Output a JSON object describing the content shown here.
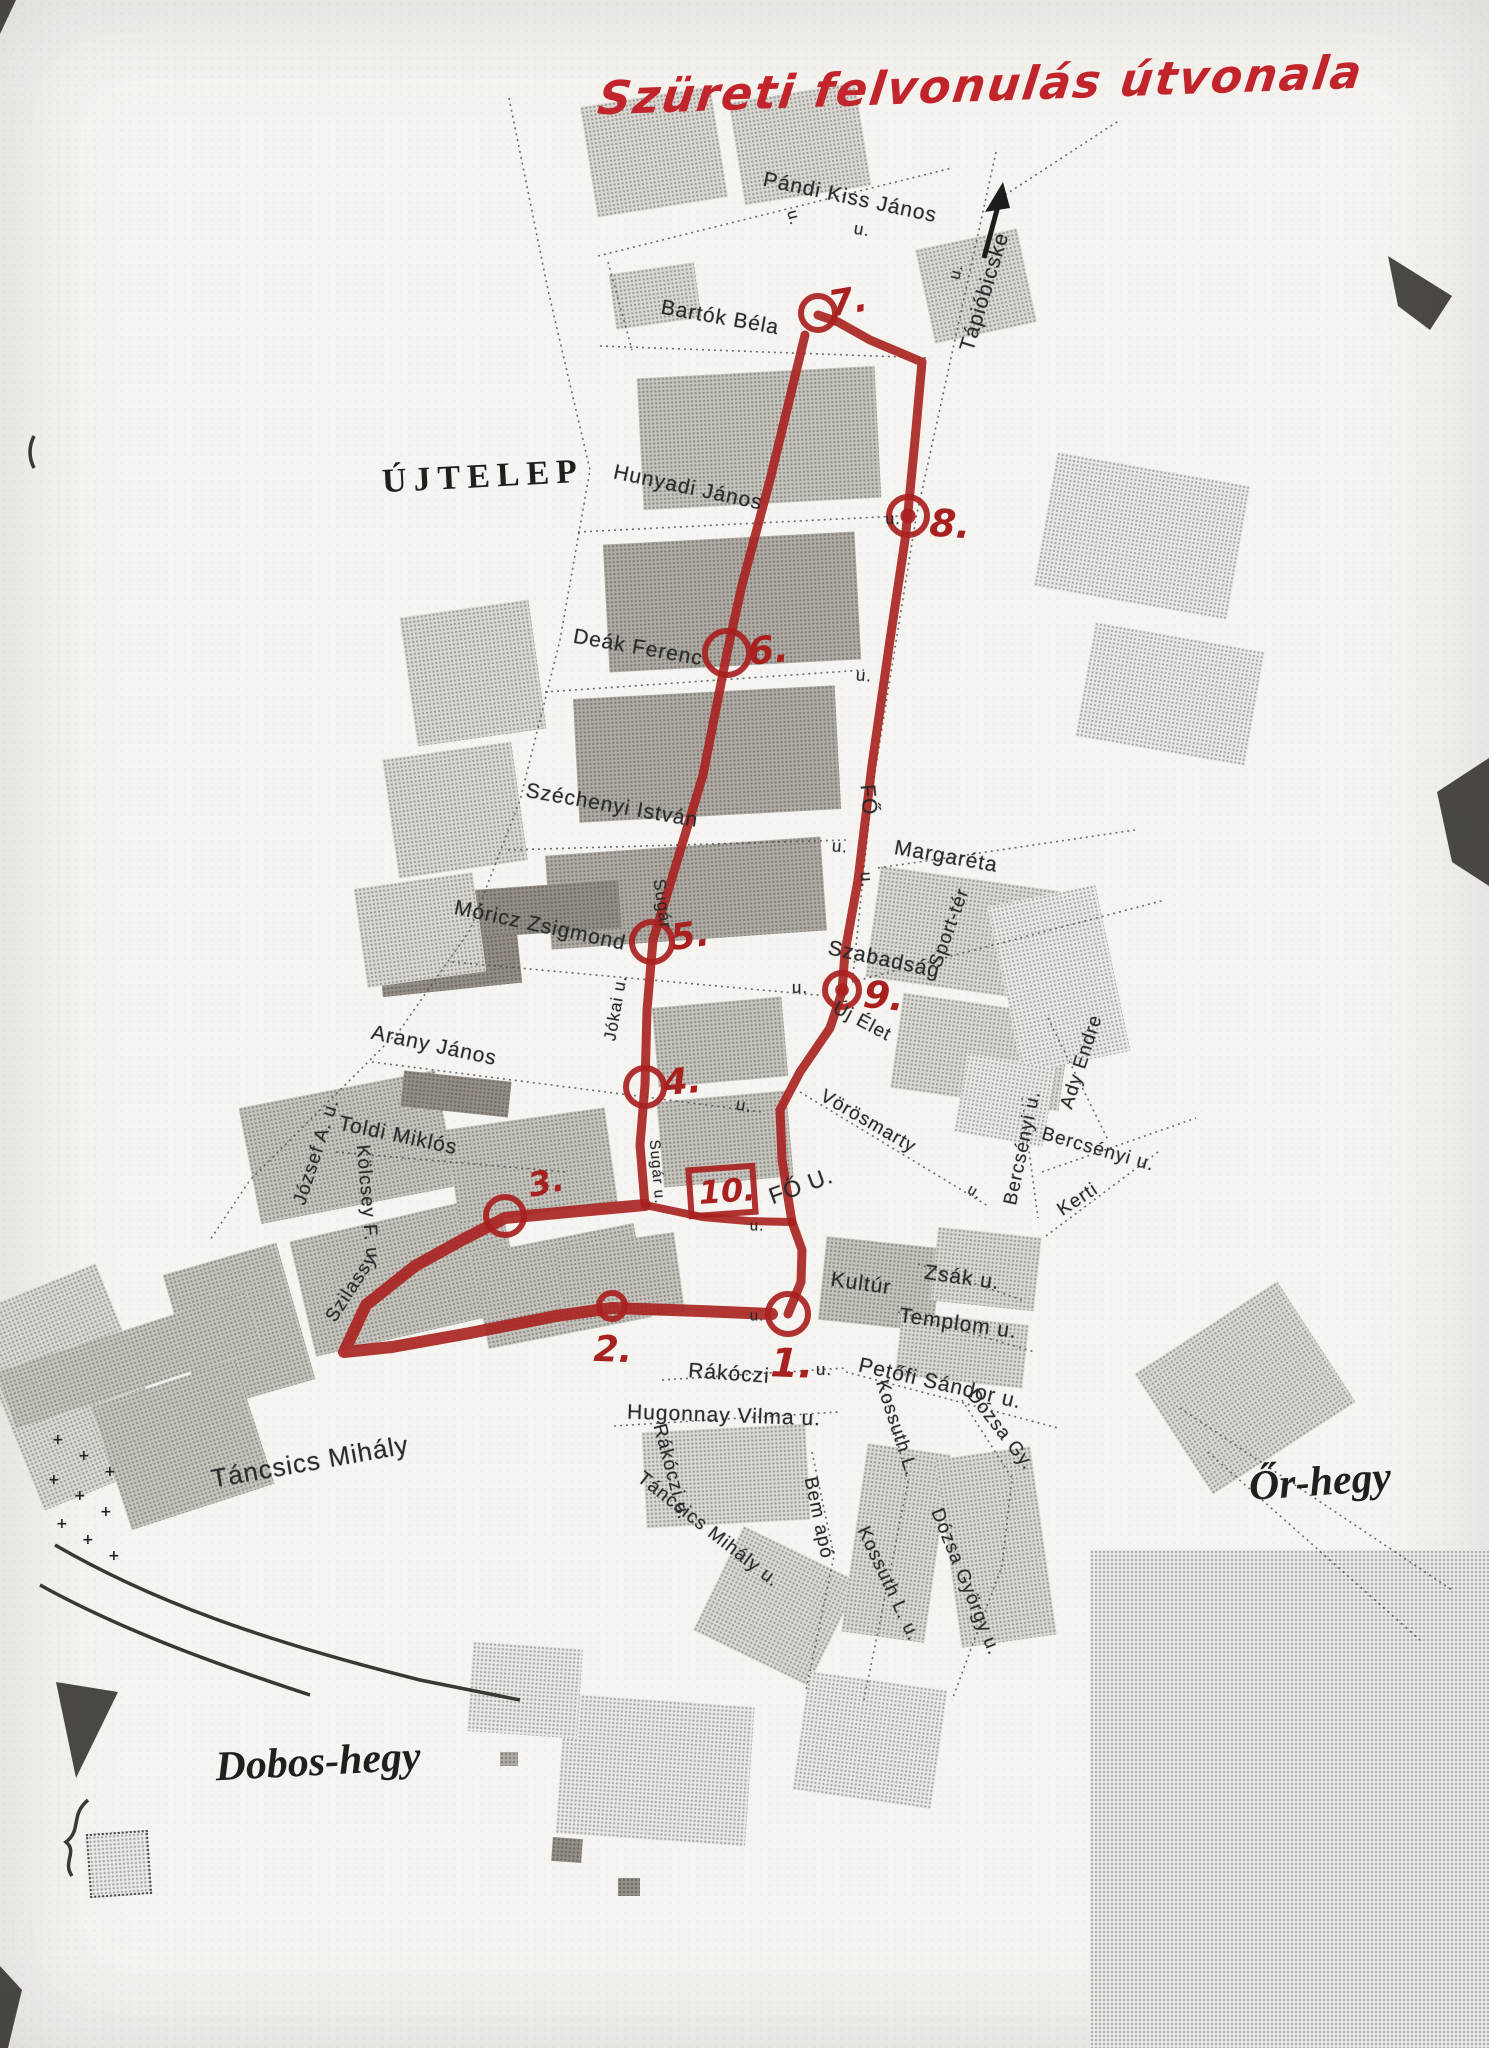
{
  "title": {
    "text": "Szüreti felvonulás útvonala",
    "color": "#c1242b"
  },
  "map": {
    "region_labels": [
      {
        "text": "ÚJTELEP",
        "x": 483,
        "y": 477,
        "rot": -3,
        "size": 34,
        "cls": "caps"
      },
      {
        "text": "Őr-hegy",
        "x": 1320,
        "y": 1482,
        "rot": -4,
        "size": 42,
        "cls": "italic"
      },
      {
        "text": "Dobos-hegy",
        "x": 318,
        "y": 1762,
        "rot": -3,
        "size": 42,
        "cls": "italic"
      }
    ],
    "street_labels": [
      {
        "text": "Pándi Kiss János",
        "x": 850,
        "y": 198,
        "rot": 12,
        "size": 21
      },
      {
        "text": "u.",
        "x": 862,
        "y": 230,
        "rot": 10,
        "size": 17
      },
      {
        "text": "u.",
        "x": 793,
        "y": 218,
        "rot": 75,
        "size": 16
      },
      {
        "text": "Tápióbicske",
        "x": 985,
        "y": 292,
        "rot": -73,
        "size": 21
      },
      {
        "text": "u.",
        "x": 957,
        "y": 272,
        "rot": -75,
        "size": 16
      },
      {
        "text": "Bartók Béla",
        "x": 720,
        "y": 318,
        "rot": 10,
        "size": 21
      },
      {
        "text": "Hunyadi János",
        "x": 688,
        "y": 488,
        "rot": 12,
        "size": 21
      },
      {
        "text": "u.",
        "x": 893,
        "y": 520,
        "rot": 0,
        "size": 16
      },
      {
        "text": "Deák Ferenc",
        "x": 638,
        "y": 648,
        "rot": 10,
        "size": 21
      },
      {
        "text": "u.",
        "x": 864,
        "y": 676,
        "rot": 5,
        "size": 17
      },
      {
        "text": "Széchenyi István",
        "x": 612,
        "y": 806,
        "rot": 10,
        "size": 21
      },
      {
        "text": "u.",
        "x": 840,
        "y": 847,
        "rot": 5,
        "size": 17
      },
      {
        "text": "FŐ",
        "x": 868,
        "y": 800,
        "rot": 85,
        "size": 21
      },
      {
        "text": "u.",
        "x": 866,
        "y": 880,
        "rot": 85,
        "size": 17
      },
      {
        "text": "Margaréta",
        "x": 946,
        "y": 857,
        "rot": 10,
        "size": 21
      },
      {
        "text": "Móricz Zsigmond",
        "x": 540,
        "y": 926,
        "rot": 12,
        "size": 21
      },
      {
        "text": "Sugár",
        "x": 662,
        "y": 904,
        "rot": 82,
        "size": 17
      },
      {
        "text": "Jókai u.",
        "x": 616,
        "y": 1008,
        "rot": -80,
        "size": 17
      },
      {
        "text": "Szabadság",
        "x": 884,
        "y": 960,
        "rot": 12,
        "size": 21
      },
      {
        "text": "u.",
        "x": 800,
        "y": 988,
        "rot": 0,
        "size": 17
      },
      {
        "text": "Új Élet",
        "x": 862,
        "y": 1022,
        "rot": 28,
        "size": 19
      },
      {
        "text": "Sport-tér",
        "x": 950,
        "y": 928,
        "rot": -70,
        "size": 19
      },
      {
        "text": "Arany János",
        "x": 434,
        "y": 1046,
        "rot": 12,
        "size": 21
      },
      {
        "text": "u.",
        "x": 744,
        "y": 1106,
        "rot": 10,
        "size": 17
      },
      {
        "text": "Toldi Miklós",
        "x": 398,
        "y": 1136,
        "rot": 12,
        "size": 21
      },
      {
        "text": "József A. u.",
        "x": 317,
        "y": 1152,
        "rot": -72,
        "size": 19
      },
      {
        "text": "Kölcsey F. u.",
        "x": 367,
        "y": 1205,
        "rot": 85,
        "size": 19
      },
      {
        "text": "Szilassy",
        "x": 352,
        "y": 1288,
        "rot": -57,
        "size": 19
      },
      {
        "text": "Vörösmarty",
        "x": 868,
        "y": 1122,
        "rot": 30,
        "size": 19
      },
      {
        "text": "u.",
        "x": 975,
        "y": 1192,
        "rot": 30,
        "size": 15
      },
      {
        "text": "Bercsényi u.",
        "x": 1023,
        "y": 1148,
        "rot": -78,
        "size": 19
      },
      {
        "text": "Bercsényi u.",
        "x": 1098,
        "y": 1150,
        "rot": 16,
        "size": 19
      },
      {
        "text": "Kerti",
        "x": 1078,
        "y": 1200,
        "rot": -33,
        "size": 19
      },
      {
        "text": "Ady Endre",
        "x": 1082,
        "y": 1062,
        "rot": -72,
        "size": 19
      },
      {
        "text": "FŐ U.",
        "x": 801,
        "y": 1186,
        "rot": -20,
        "size": 23
      },
      {
        "text": "u.",
        "x": 757,
        "y": 1226,
        "rot": 0,
        "size": 15
      },
      {
        "text": "Sugár u.",
        "x": 657,
        "y": 1172,
        "rot": 85,
        "size": 15
      },
      {
        "text": "Kultúr",
        "x": 861,
        "y": 1284,
        "rot": 8,
        "size": 21
      },
      {
        "text": "Zsák u.",
        "x": 962,
        "y": 1278,
        "rot": 8,
        "size": 21
      },
      {
        "text": "Templom u.",
        "x": 958,
        "y": 1324,
        "rot": 8,
        "size": 21
      },
      {
        "text": "u.",
        "x": 757,
        "y": 1316,
        "rot": 0,
        "size": 15
      },
      {
        "text": "Rákóczi",
        "x": 729,
        "y": 1374,
        "rot": 4,
        "size": 21
      },
      {
        "text": "u.",
        "x": 824,
        "y": 1370,
        "rot": 0,
        "size": 17
      },
      {
        "text": "Petőfi Sándor u.",
        "x": 940,
        "y": 1384,
        "rot": 13,
        "size": 21
      },
      {
        "text": "Hugonnay Vilma u.",
        "x": 724,
        "y": 1416,
        "rot": 2,
        "size": 21
      },
      {
        "text": "Rákóczi u.",
        "x": 671,
        "y": 1472,
        "rot": 75,
        "size": 19
      },
      {
        "text": "Táncsics Mihály",
        "x": 310,
        "y": 1462,
        "rot": -10,
        "size": 26
      },
      {
        "text": "Táncsics Mihály u.",
        "x": 708,
        "y": 1530,
        "rot": 38,
        "size": 19
      },
      {
        "text": "Bem apó",
        "x": 818,
        "y": 1518,
        "rot": 78,
        "size": 19
      },
      {
        "text": "Kossuth L.",
        "x": 896,
        "y": 1428,
        "rot": 72,
        "size": 19
      },
      {
        "text": "Kossuth L. u.",
        "x": 888,
        "y": 1584,
        "rot": 65,
        "size": 19
      },
      {
        "text": "Dózsa Gy.",
        "x": 1000,
        "y": 1430,
        "rot": 52,
        "size": 19
      },
      {
        "text": "Dózsa György u.",
        "x": 965,
        "y": 1582,
        "rot": 68,
        "size": 19
      }
    ],
    "route": {
      "color": "#a8211f",
      "segments": [
        {
          "pts": "805,335 770,480 742,585 727,653 703,775 672,878 653,940 647,1010 645,1085 640,1145 645,1205",
          "w": 9
        },
        {
          "pts": "645,1205 568,1212 505,1218 462,1240 415,1266 366,1305 344,1352 392,1347 470,1333 556,1316 612,1308 700,1311 772,1314",
          "w": 12
        },
        {
          "pts": "788,1314 801,1282 802,1250 792,1222",
          "w": 9
        },
        {
          "pts": "645,1205 702,1217 748,1221 792,1222",
          "w": 8
        },
        {
          "pts": "792,1222 782,1160 780,1110 800,1072 830,1028 842,992 845,952 858,880 872,765 890,640 905,540 908,512 915,440 922,362 870,340 838,322 818,315",
          "w": 9
        }
      ]
    },
    "markers": [
      {
        "id": "7",
        "shape": "circle",
        "cx": 818,
        "cy": 313,
        "r": 17,
        "label": "7.",
        "lx": 848,
        "ly": 302,
        "lsize": 36,
        "lrot": -10
      },
      {
        "id": "8",
        "shape": "double",
        "cx": 908,
        "cy": 516,
        "r": 19,
        "label": "8.",
        "lx": 950,
        "ly": 524,
        "lsize": 38,
        "lrot": 4
      },
      {
        "id": "6",
        "shape": "circle",
        "cx": 727,
        "cy": 653,
        "r": 22,
        "label": "6.",
        "lx": 768,
        "ly": 650,
        "lsize": 38,
        "lrot": -5
      },
      {
        "id": "5",
        "shape": "circle",
        "cx": 652,
        "cy": 942,
        "r": 20,
        "label": "5.",
        "lx": 690,
        "ly": 936,
        "lsize": 36,
        "lrot": -8
      },
      {
        "id": "9",
        "shape": "double",
        "cx": 842,
        "cy": 990,
        "r": 17,
        "label": "9.",
        "lx": 884,
        "ly": 996,
        "lsize": 38,
        "lrot": 6
      },
      {
        "id": "4",
        "shape": "circle",
        "cx": 645,
        "cy": 1087,
        "r": 19,
        "label": "4.",
        "lx": 682,
        "ly": 1082,
        "lsize": 36,
        "lrot": -5
      },
      {
        "id": "3",
        "shape": "circle",
        "cx": 505,
        "cy": 1216,
        "r": 19,
        "label": "3.",
        "lx": 546,
        "ly": 1182,
        "lsize": 33,
        "lrot": -12
      },
      {
        "id": "10",
        "shape": "square",
        "cx": 722,
        "cy": 1191,
        "w": 64,
        "h": 46,
        "rot": -4,
        "label": "10.",
        "lx": 727,
        "ly": 1191,
        "lsize": 32,
        "lrot": -4
      },
      {
        "id": "1",
        "shape": "circle",
        "cx": 788,
        "cy": 1314,
        "r": 20,
        "label": "1.",
        "lx": 792,
        "ly": 1364,
        "lsize": 40,
        "lrot": 2
      },
      {
        "id": "2",
        "shape": "circle",
        "cx": 612,
        "cy": 1306,
        "r": 13,
        "label": "2.",
        "lx": 613,
        "ly": 1350,
        "lsize": 36,
        "lrot": 2
      }
    ],
    "decor": {
      "blocks": [
        [
          588,
          96,
          132,
          112,
          -9,
          1
        ],
        [
          736,
          92,
          128,
          104,
          -9,
          1
        ],
        [
          612,
          268,
          86,
          56,
          -8,
          1
        ],
        [
          640,
          372,
          238,
          132,
          -3,
          2
        ],
        [
          606,
          538,
          252,
          128,
          -3,
          3
        ],
        [
          576,
          692,
          262,
          124,
          -3,
          3
        ],
        [
          548,
          846,
          276,
          94,
          -4,
          3
        ],
        [
          470,
          885,
          150,
          48,
          -4,
          4
        ],
        [
          380,
          940,
          140,
          50,
          -6,
          4
        ],
        [
          408,
          608,
          130,
          130,
          -8,
          1
        ],
        [
          390,
          750,
          130,
          120,
          -8,
          1
        ],
        [
          360,
          880,
          120,
          100,
          -8,
          1
        ],
        [
          924,
          238,
          104,
          96,
          -12,
          1
        ],
        [
          1044,
          468,
          196,
          136,
          10,
          0
        ],
        [
          1084,
          636,
          172,
          116,
          10,
          0
        ],
        [
          872,
          880,
          210,
          112,
          8,
          1
        ],
        [
          896,
          1004,
          170,
          96,
          8,
          1
        ],
        [
          1004,
          894,
          110,
          170,
          -12,
          0
        ],
        [
          655,
          1002,
          130,
          80,
          -5,
          2
        ],
        [
          660,
          1096,
          130,
          86,
          -5,
          2
        ],
        [
          960,
          1060,
          90,
          80,
          10,
          0
        ],
        [
          248,
          1088,
          200,
          118,
          -11,
          2
        ],
        [
          300,
          1216,
          214,
          118,
          -13,
          2
        ],
        [
          452,
          1118,
          160,
          96,
          -8,
          2
        ],
        [
          478,
          1238,
          166,
          96,
          -11,
          2
        ],
        [
          180,
          1256,
          118,
          142,
          -16,
          2
        ],
        [
          560,
          1240,
          120,
          80,
          -8,
          2
        ],
        [
          402,
          1076,
          108,
          36,
          6,
          4
        ],
        [
          822,
          1242,
          116,
          84,
          6,
          2
        ],
        [
          934,
          1232,
          104,
          74,
          6,
          1
        ],
        [
          898,
          1318,
          128,
          64,
          6,
          1
        ],
        [
          644,
          1428,
          164,
          96,
          -3,
          1
        ],
        [
          712,
          1548,
          128,
          116,
          26,
          1
        ],
        [
          854,
          1448,
          84,
          190,
          8,
          1
        ],
        [
          948,
          1452,
          96,
          190,
          -8,
          1
        ],
        [
          800,
          1680,
          140,
          120,
          8,
          0
        ],
        [
          1090,
          1550,
          400,
          500,
          0,
          0
        ],
        [
          1160,
          1316,
          170,
          144,
          -33,
          1
        ],
        [
          0,
          1282,
          140,
          210,
          -22,
          1
        ],
        [
          108,
          1380,
          150,
          130,
          -18,
          2
        ],
        [
          0,
          1330,
          260,
          60,
          -18,
          2
        ],
        [
          560,
          1700,
          190,
          140,
          4,
          0
        ],
        [
          470,
          1645,
          110,
          90,
          4,
          0
        ],
        [
          552,
          1838,
          30,
          24,
          4,
          4
        ],
        [
          618,
          1878,
          22,
          18,
          0,
          4
        ],
        [
          500,
          1752,
          18,
          14,
          0,
          3
        ]
      ],
      "dotted_roads": [
        "598,256 952,168",
        "608,262 632,350",
        "509,98 548,290 590,470 560,640 520,800 470,930 400,1030 330,1100 250,1180 210,1240",
        "600,346 930,358",
        "578,532 898,516",
        "545,692 864,670",
        "508,850 846,840",
        "878,868 1135,830",
        "452,962 828,996",
        "852,982 1165,900",
        "372,1062 762,1112",
        "336,1152 566,1172",
        "800,1092 988,1206",
        "1048,1018 1108,1140",
        "1022,1098 1038,1218",
        "1042,1172 1196,1118",
        "1046,1236 1158,1152",
        "918,1264 1022,1300",
        "898,1312 1035,1352",
        "846,1372 1058,1428",
        "662,1380 846,1368",
        "614,1426 838,1412",
        "812,1452 834,1556 806,1690",
        "882,1382 908,1482 892,1562 864,1700",
        "962,1400 1012,1478 1002,1566 952,1700",
        "1180,1408 1452,1590",
        "1208,1452 1420,1640",
        "996,152 916,518 872,790 852,985",
        "1005,195 1120,120"
      ],
      "dark_polys": [
        "1388,256 1452,296 1430,330 1398,306",
        "1437,792 1489,758 1489,886 1452,862",
        "56,1682 118,1692 76,1778",
        "0,0 16,0 0,34",
        "0,1966 22,1990 8,2048 0,2048"
      ],
      "dark_paths": [
        "M55,1545 C150,1600 260,1640 420,1680 L520,1700",
        "M40,1585 C130,1635 240,1672 310,1695",
        "M34,436 Q26,452 34,468",
        "M88,1800 C70,1815 82,1830 66,1842 C78,1852 62,1862 72,1876"
      ],
      "dotted_squares": [
        [
          88,
          1832,
          58,
          60,
          -4
        ]
      ],
      "crosses": [
        [
          52,
          1432
        ],
        [
          78,
          1448
        ],
        [
          104,
          1464
        ],
        [
          48,
          1472
        ],
        [
          74,
          1488
        ],
        [
          100,
          1504
        ],
        [
          56,
          1516
        ],
        [
          82,
          1532
        ],
        [
          108,
          1548
        ]
      ]
    }
  }
}
